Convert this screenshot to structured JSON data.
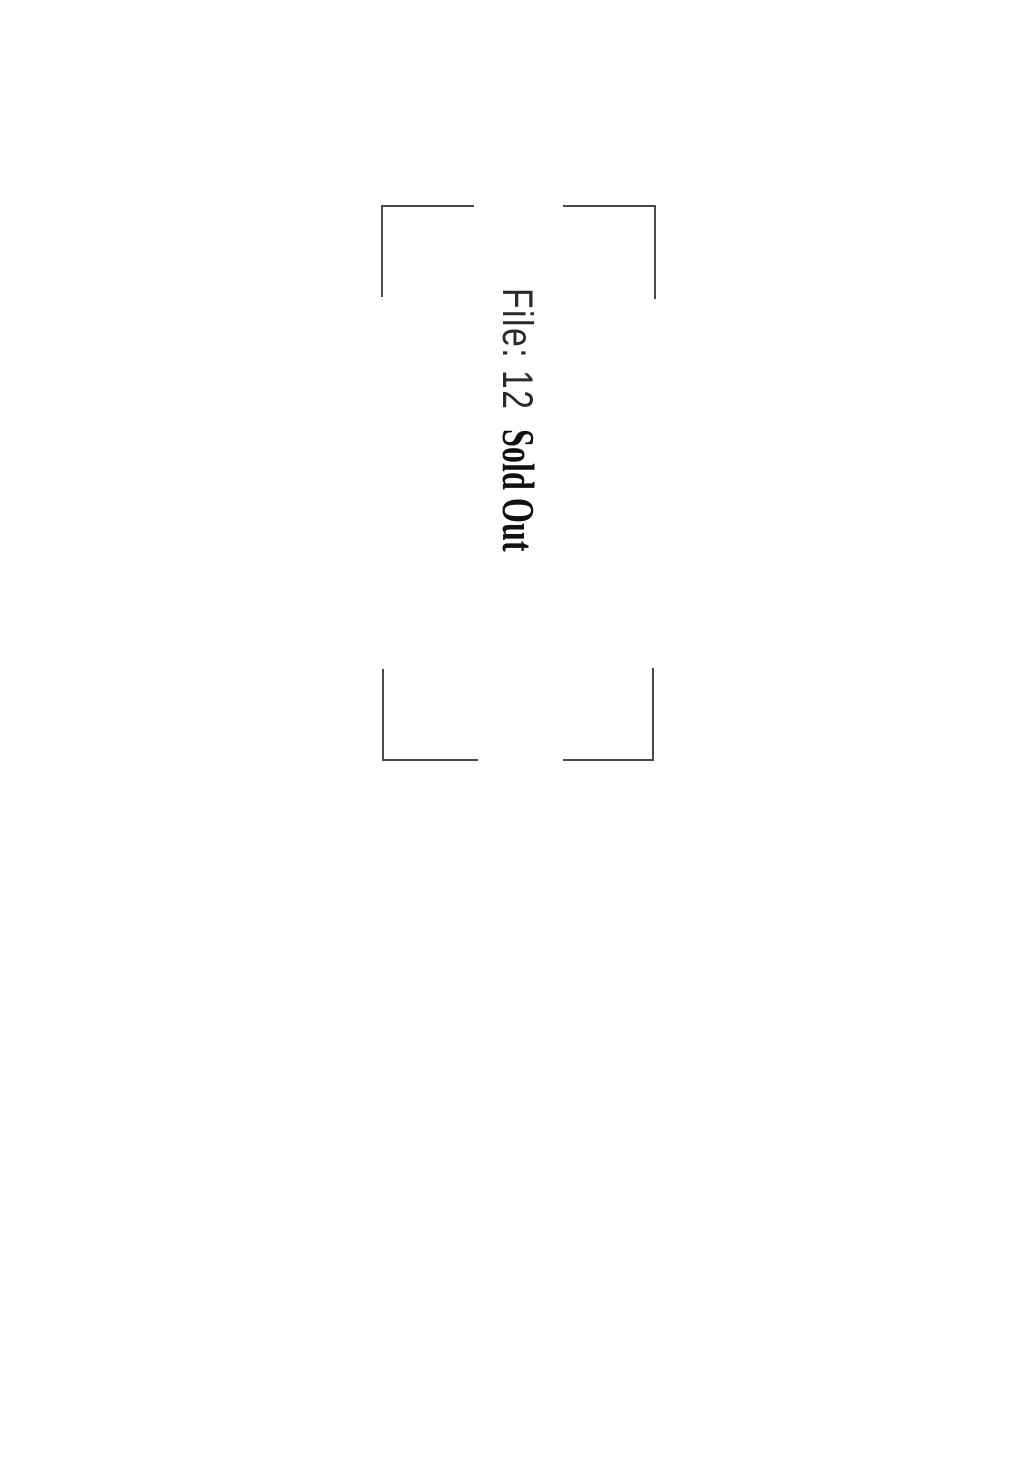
{
  "page": {
    "kind": "scanned chapter title page, rotated 90 degrees",
    "background_color": "#ffffff",
    "frame_line_color": "#4a4a4a"
  },
  "title": {
    "file_label": "File: 12",
    "chapter_title": "Sold Out",
    "rotation_deg": 90,
    "file_label_color": "#2a2a2a",
    "chapter_title_color": "#111111"
  }
}
